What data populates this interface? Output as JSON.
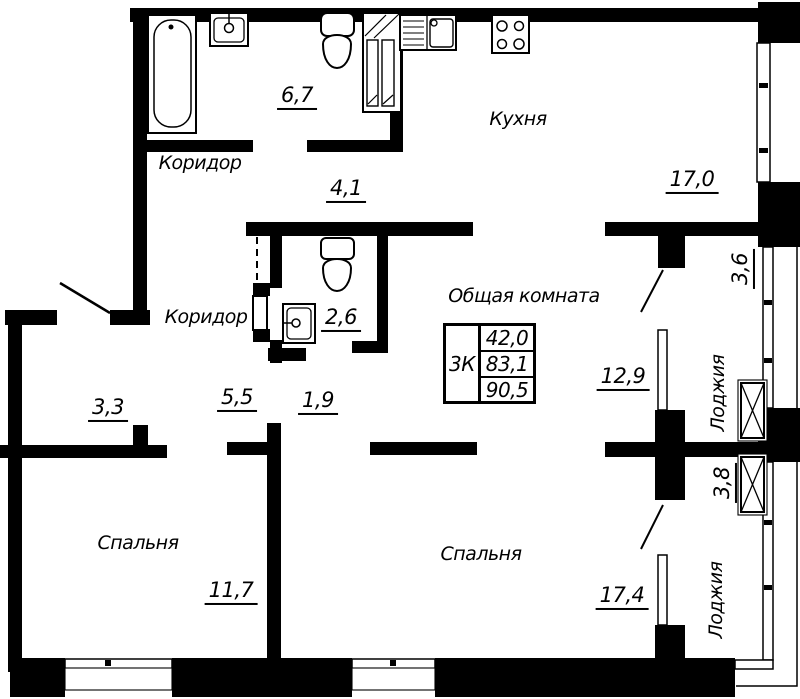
{
  "colors": {
    "walls": "#000000",
    "background": "#ffffff"
  },
  "labels": {
    "corridor_top": "Коридор",
    "corridor_mid": "Коридор",
    "kitchen": "Кухня",
    "common_room": "Общая комната",
    "bedroom_left": "Спальня",
    "bedroom_right": "Спальня",
    "loggia_top": "Лоджия",
    "loggia_bottom": "Лоджия"
  },
  "areas": {
    "bathroom": "6,7",
    "hall": "4,1",
    "kitchen": "17,0",
    "loggia_top": "3,6",
    "wc": "2,6",
    "living": "12,9",
    "closet": "3,3",
    "corridor_a": "5,5",
    "corridor_b": "1,9",
    "bedroom_left": "11,7",
    "bedroom_right": "17,4",
    "loggia_bottom": "3,8"
  },
  "info_table": {
    "type": "3К",
    "values": [
      "42,0",
      "83,1",
      "90,5"
    ]
  },
  "fixture_icons": [
    "bathtub-icon",
    "wall-sink-icon",
    "toilet-icon",
    "vent-shaft-icon",
    "kitchen-sink-icon",
    "stove-icon",
    "shaft-cross-icon",
    "door-swing-icon"
  ]
}
